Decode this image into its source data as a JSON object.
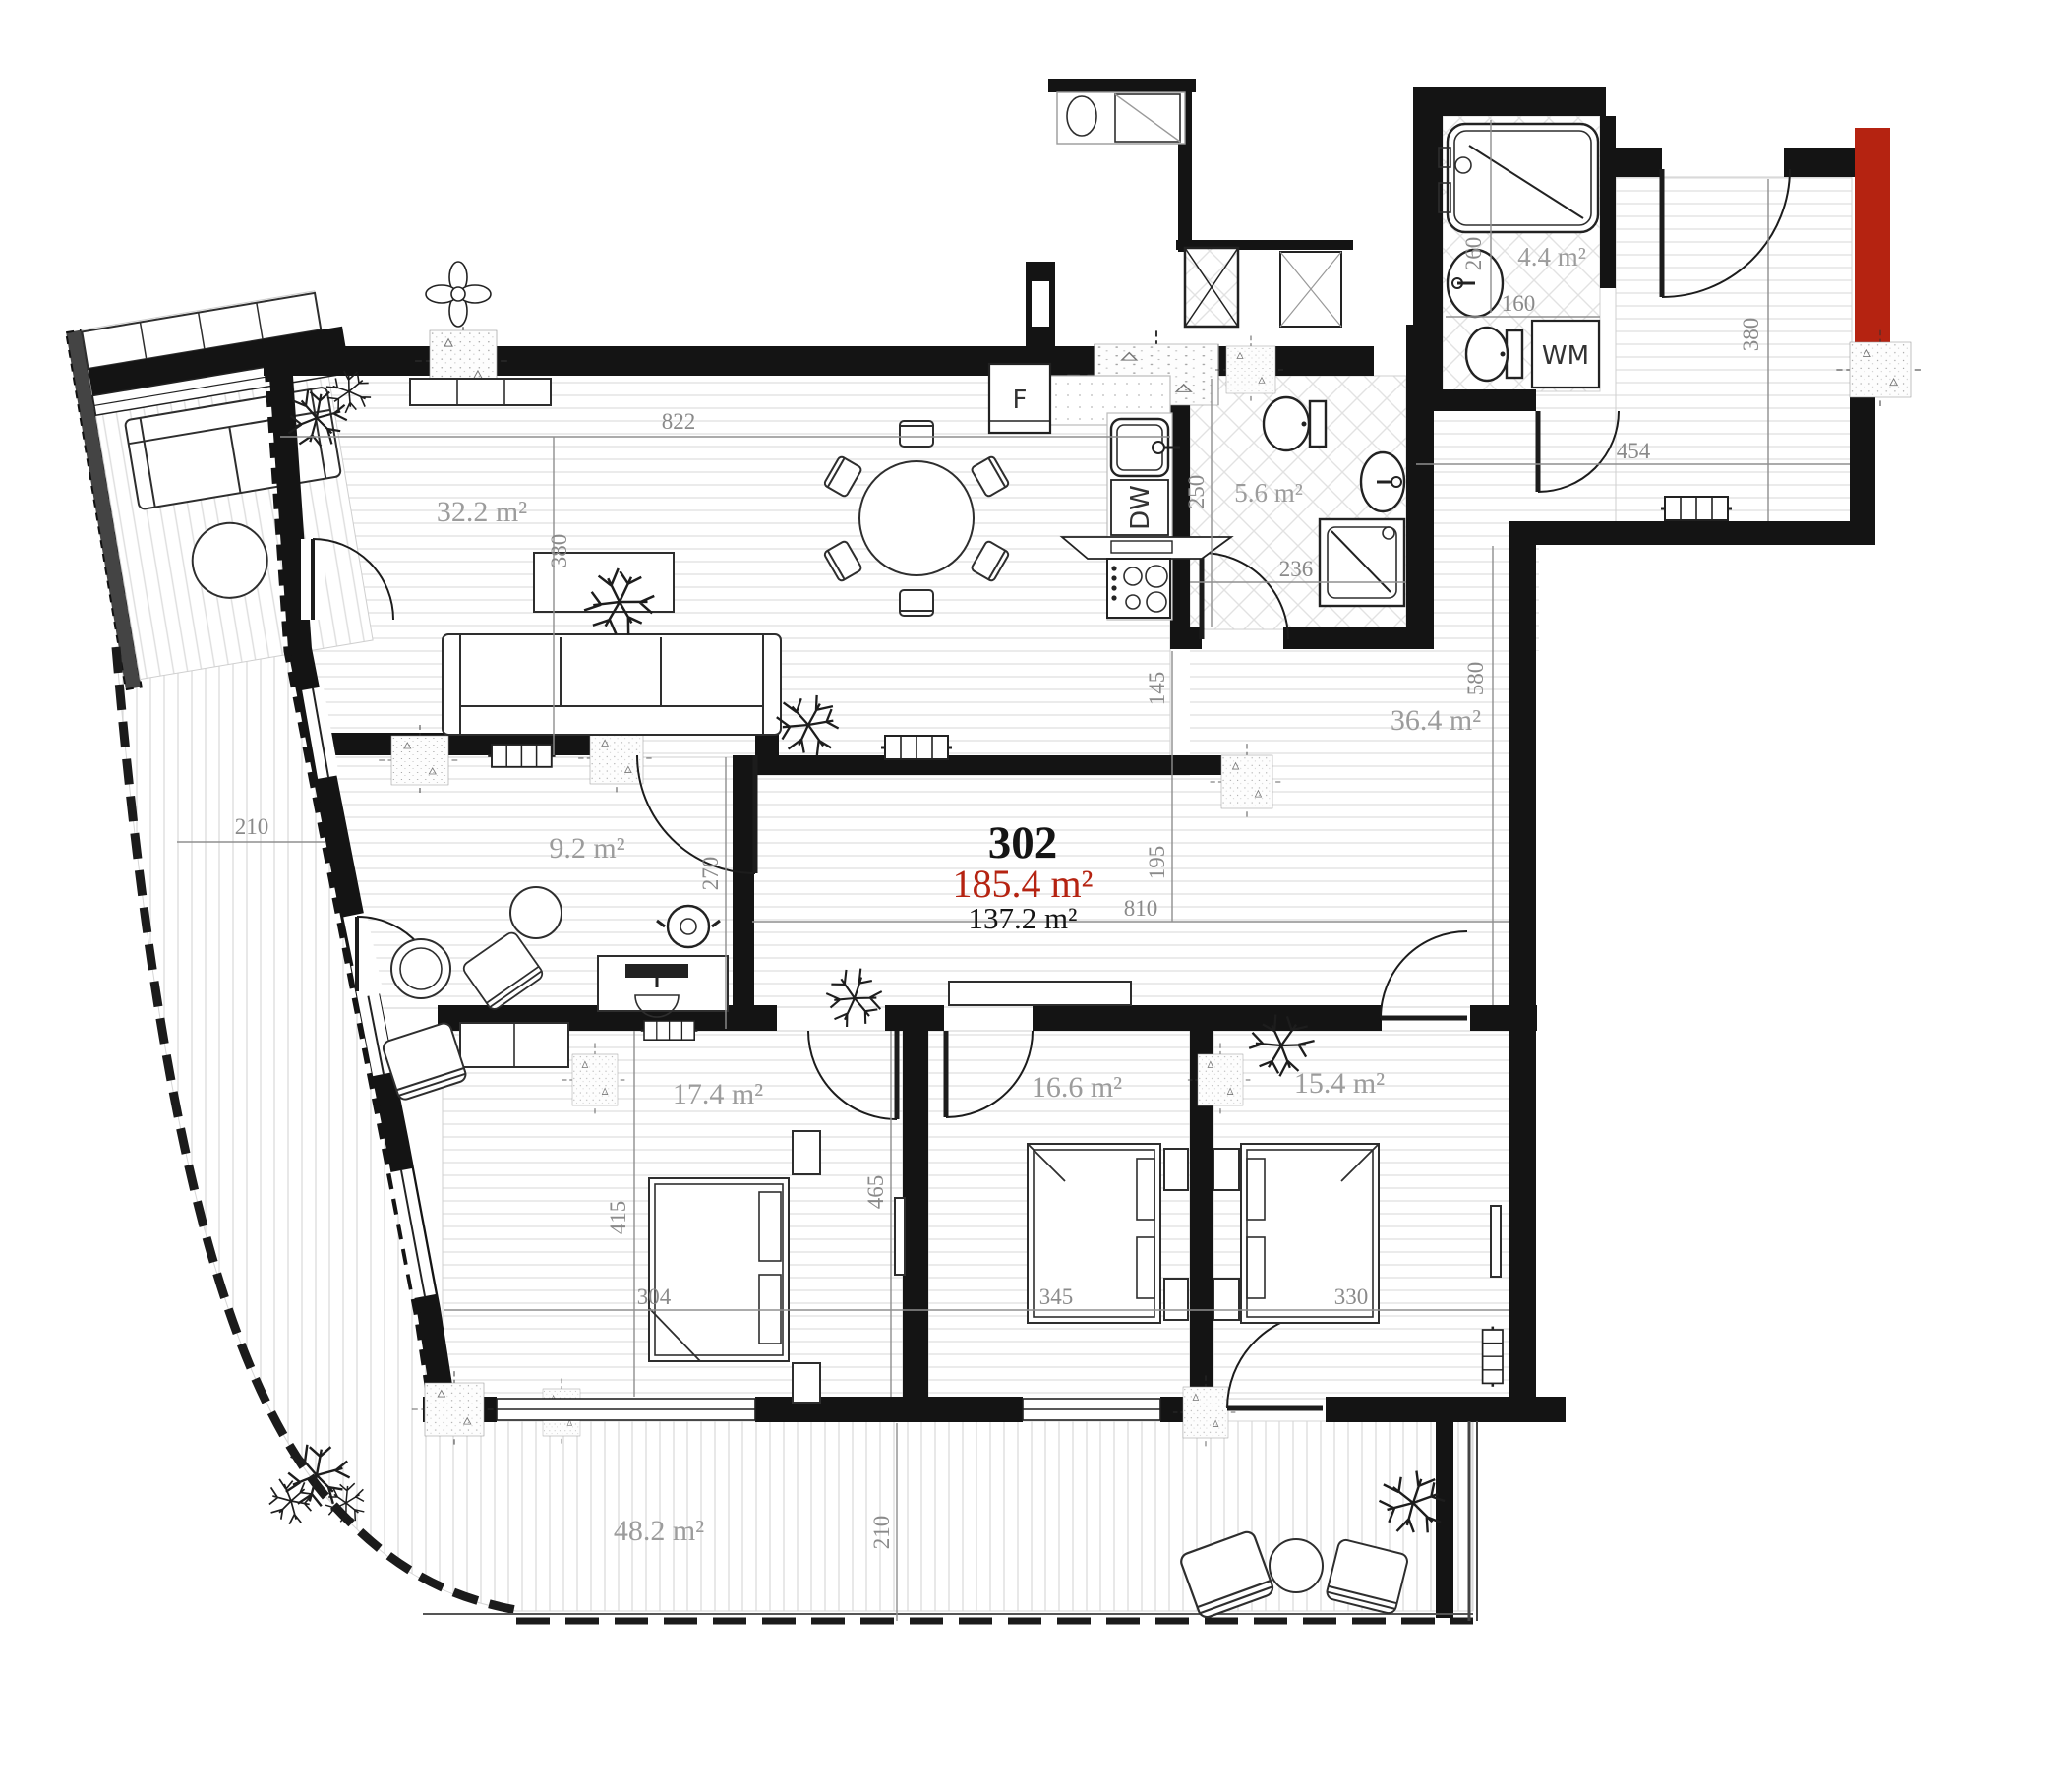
{
  "title": "Apartment floor plan",
  "unit": {
    "number": "302",
    "area_total": "185.4 m²",
    "area_net": "137.2 m²"
  },
  "rooms": {
    "living": {
      "area": "32.2 m²"
    },
    "bathroom": {
      "area": "4.4 m²"
    },
    "wc": {
      "area": "5.6 m²"
    },
    "hall": {
      "area": "36.4 m²"
    },
    "office": {
      "area": "9.2 m²"
    },
    "bedroom1": {
      "area": "17.4 m²"
    },
    "bedroom2": {
      "area": "16.6 m²"
    },
    "bedroom3": {
      "area": "15.4 m²"
    },
    "terrace": {
      "area": "48.2 m²"
    }
  },
  "appliances": {
    "fridge": "F",
    "dishwasher": "DW",
    "washing_machine": "WM"
  },
  "dims": {
    "living_w": "822",
    "living_h": "380",
    "entry_w": "454",
    "entry_h": "380",
    "wc_h": "250",
    "wc_w": "236",
    "bath_h": "260",
    "bath_w": "160",
    "hall_gap1": "145",
    "hall_gap2": "195",
    "hall_w": "810",
    "hall_h": "580",
    "office_h": "270",
    "bed1_h": "415",
    "bed1_w": "304",
    "bed2_w": "345",
    "bed3_w": "330",
    "beds_h": "465",
    "terrace_h": "210",
    "terrace_left_w": "210"
  },
  "colors": {
    "wall": "#141414",
    "accent_red": "#b52311",
    "dim_text": "#8a8a8a",
    "room_text": "#9c9c9c"
  }
}
